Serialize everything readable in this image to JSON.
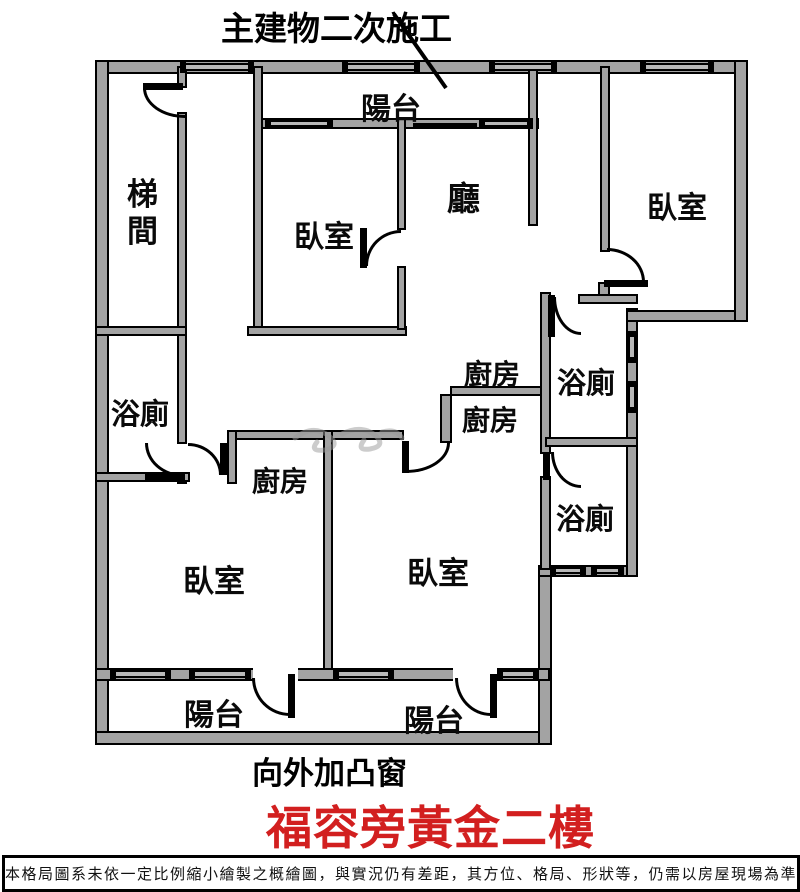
{
  "annotations": {
    "top": "主建物二次施工",
    "bottom": "向外加凸窗"
  },
  "rooms": [
    {
      "id": "stairwell",
      "label": "梯間"
    },
    {
      "id": "balcony-top",
      "label": "陽台"
    },
    {
      "id": "bedroom-top-middle",
      "label": "臥室"
    },
    {
      "id": "living-room",
      "label": "廳"
    },
    {
      "id": "bedroom-top-right",
      "label": "臥室"
    },
    {
      "id": "bathroom-left",
      "label": "浴廁"
    },
    {
      "id": "kitchen-upper",
      "label": "廚房"
    },
    {
      "id": "kitchen-lower",
      "label": "廚房"
    },
    {
      "id": "bathroom-right-upper",
      "label": "浴廁"
    },
    {
      "id": "bathroom-right-lower",
      "label": "浴廁"
    },
    {
      "id": "kitchen-bottom-left",
      "label": "廚房"
    },
    {
      "id": "bedroom-bottom-left",
      "label": "臥室"
    },
    {
      "id": "bedroom-bottom-middle",
      "label": "臥室"
    },
    {
      "id": "balcony-bottom-left",
      "label": "陽台"
    },
    {
      "id": "balcony-bottom-right",
      "label": "陽台"
    }
  ],
  "title": {
    "text": "福容旁黃金二樓",
    "color": "#d21f1f"
  },
  "disclaimer": {
    "text": "本格局圖系未依一定比例縮小繪製之概繪圖，與實況仍有差距，其方位、格局、形狀等，仍需以房屋現場為準"
  },
  "colors": {
    "wall_fill": "#a3a3a3",
    "line": "#000000",
    "background": "#ffffff",
    "title_red": "#d21f1f"
  }
}
